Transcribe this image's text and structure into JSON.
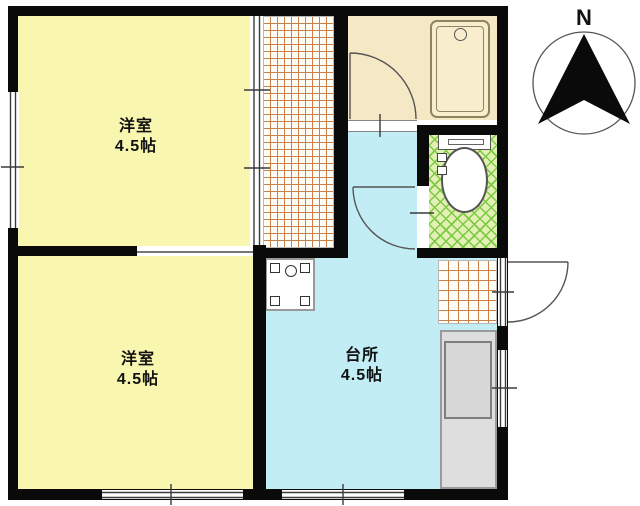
{
  "rooms": {
    "bedroom_top": {
      "name": "洋室",
      "size": "4.5帖"
    },
    "bedroom_bottom": {
      "name": "洋室",
      "size": "4.5帖"
    },
    "kitchen": {
      "name": "台所",
      "size": "4.5帖"
    }
  },
  "compass": {
    "north_label": "N"
  },
  "colors": {
    "room_yellow": "#f9f6b0",
    "kitchen_blue": "#c2edf4",
    "bath_cream": "#f5e8c5",
    "toilet_green_bg": "#e3f0b4",
    "toilet_green_line": "#7cc944",
    "tile_line_orange": "#c98049",
    "counter_gray": "#dedede",
    "wall_black": "#0a0a0a"
  }
}
